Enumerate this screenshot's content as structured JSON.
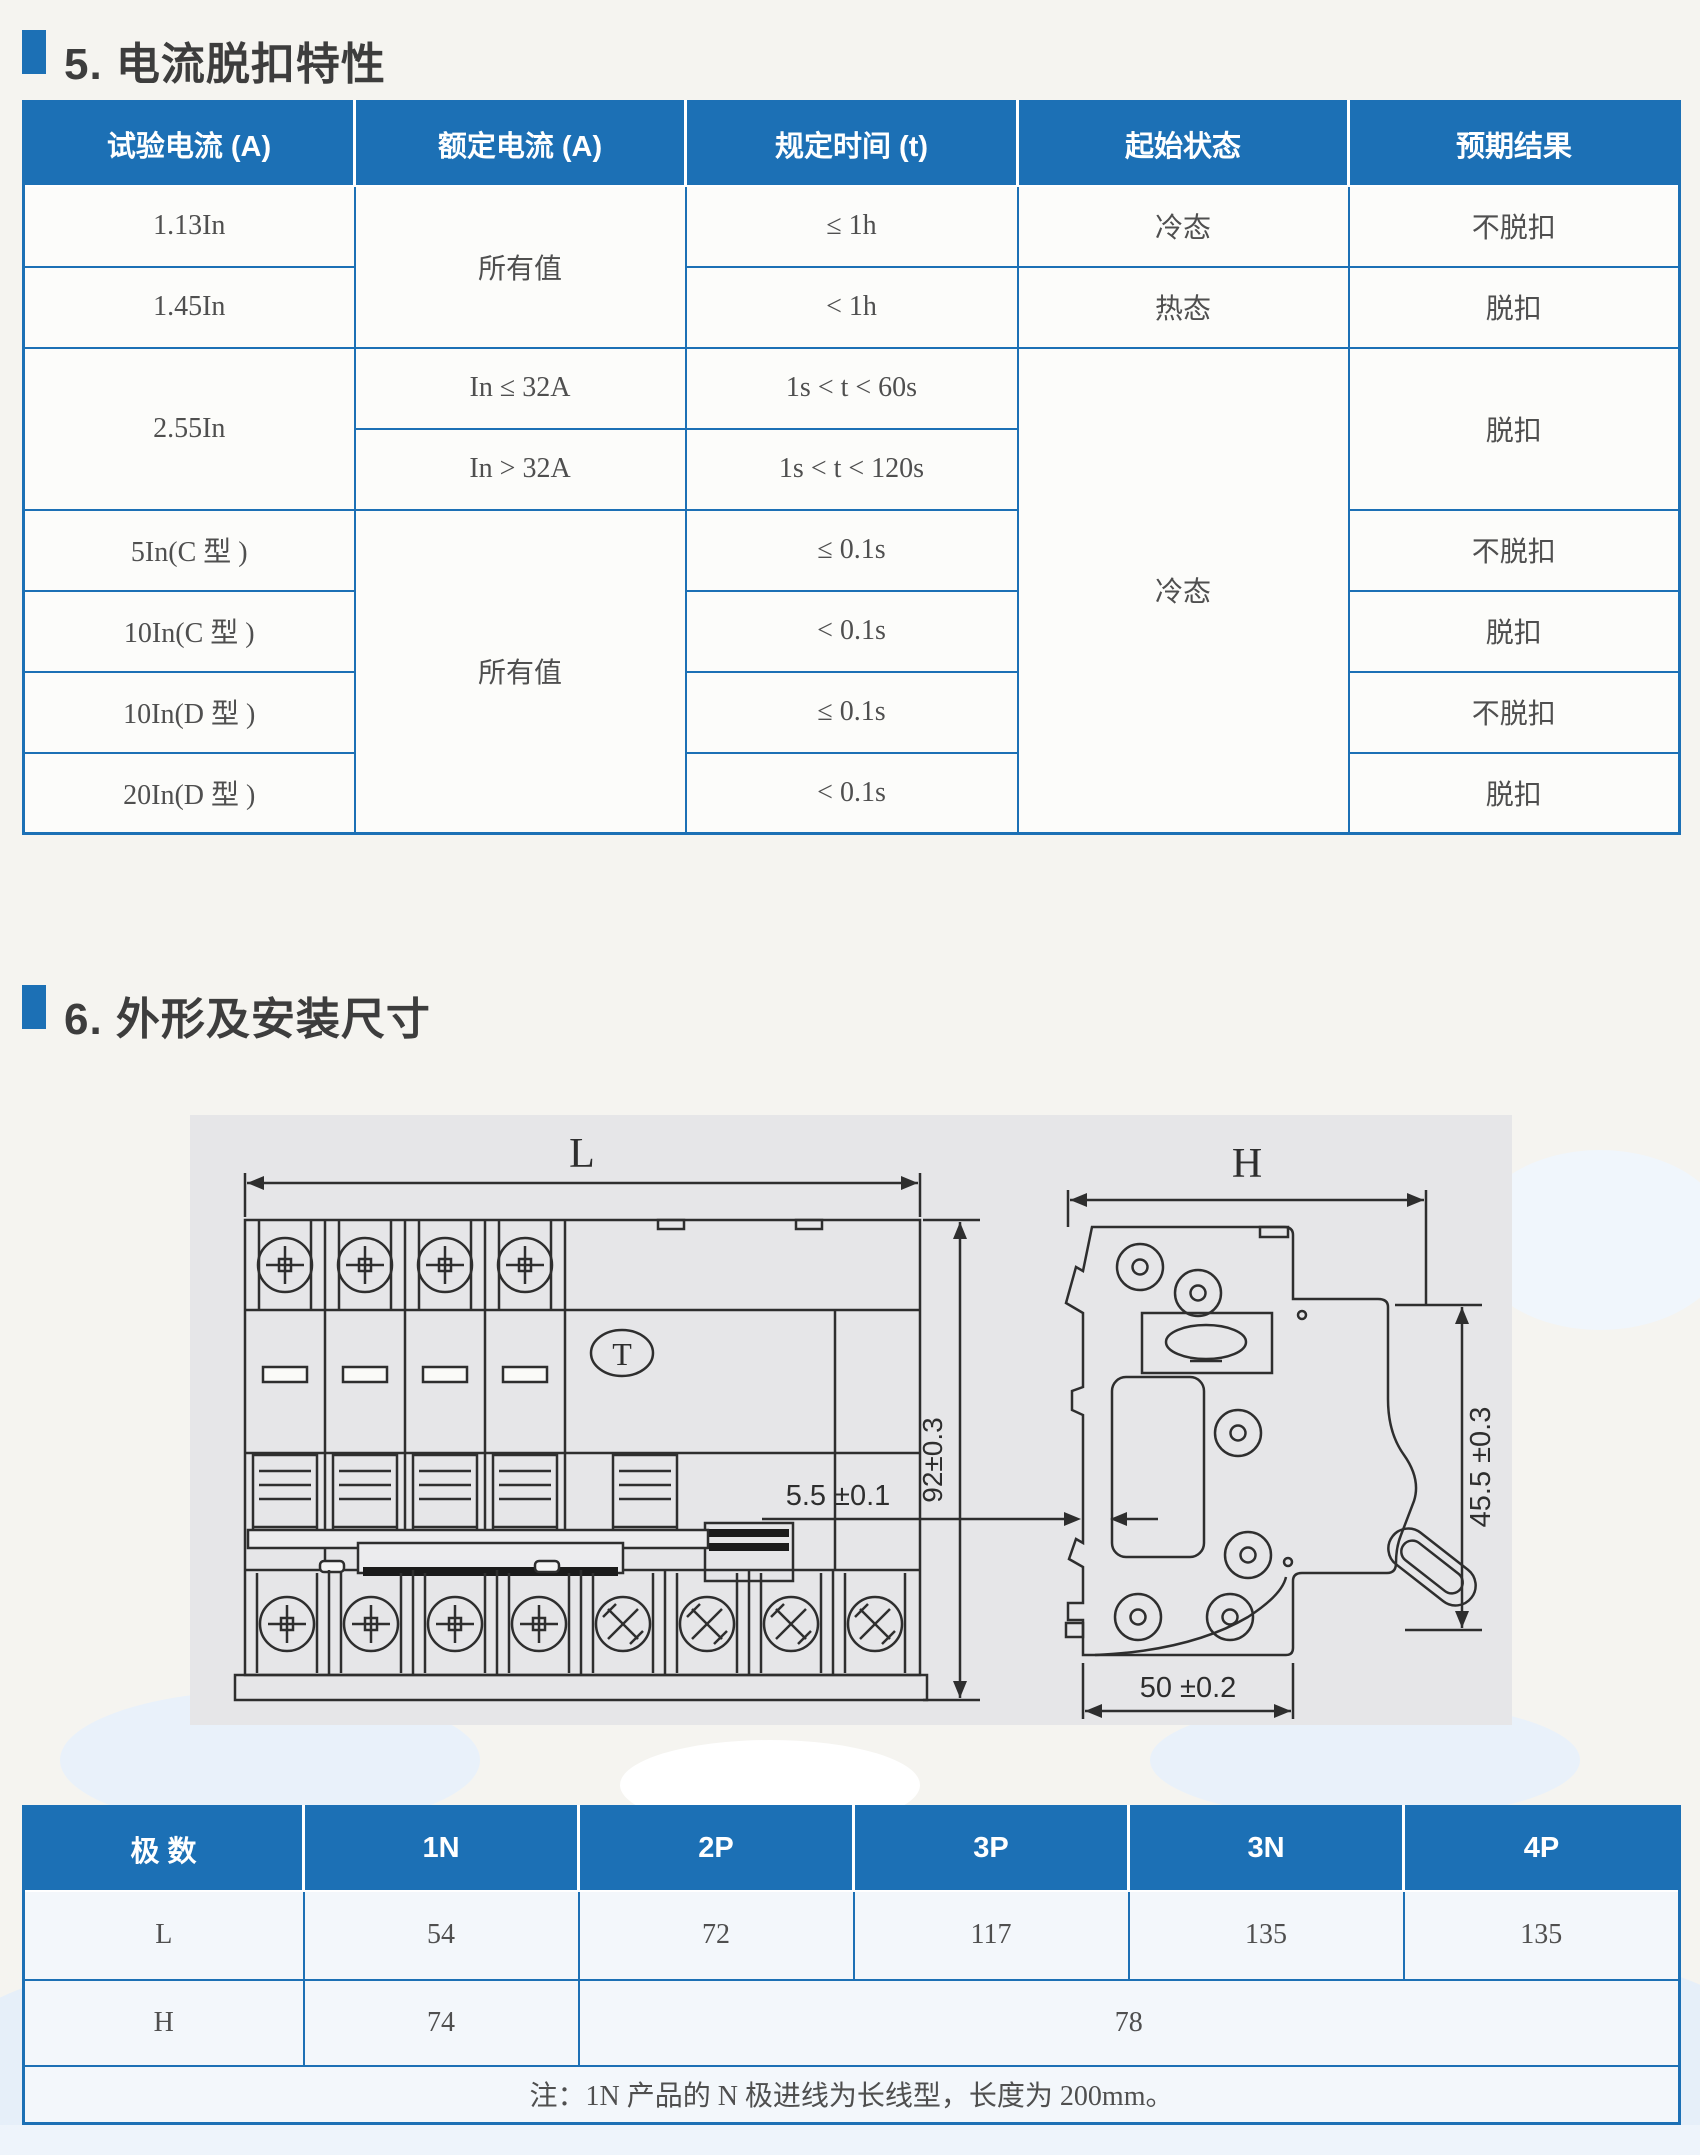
{
  "colors": {
    "accent_blue": "#1c70b5",
    "header_text": "#ffffff",
    "body_text": "#4f4f4f",
    "title_text": "#3d3d3d",
    "drawing_line": "#2e2e2e",
    "drawing_bg": "#e6e6e8"
  },
  "section5": {
    "title": "5. 电流脱扣特性"
  },
  "trip_table": {
    "headers": [
      "试验电流 (A)",
      "额定电流 (A)",
      "规定时间 (t)",
      "起始状态",
      "预期结果"
    ],
    "r1c1": "1.13In",
    "r1c2": "所有值",
    "r1c3": "≤ 1h",
    "r1c4": "冷态",
    "r1c5": "不脱扣",
    "r2c1": "1.45In",
    "r2c3": "< 1h",
    "r2c4": "热态",
    "r2c5": "脱扣",
    "r3c1": "2.55In",
    "r3c2": "In ≤ 32A",
    "r3c3": "1s < t < 60s",
    "r3c4": "冷态",
    "r3c5": "脱扣",
    "r4c2": "In > 32A",
    "r4c3": "1s < t < 120s",
    "r5c1": "5In(C 型 )",
    "r5c2": "所有值",
    "r5c3": "≤ 0.1s",
    "r5c5": "不脱扣",
    "r6c1": "10In(C 型 )",
    "r6c3": "< 0.1s",
    "r6c5": "脱扣",
    "r7c1": "10In(D 型 )",
    "r7c3": "≤ 0.1s",
    "r7c5": "不脱扣",
    "r8c1": "20In(D 型 )",
    "r8c3": "< 0.1s",
    "r8c5": "脱扣"
  },
  "section6": {
    "title": "6. 外形及安装尺寸"
  },
  "drawing": {
    "dim_L": "L",
    "dim_H": "H",
    "dim_height": "92±0.3",
    "dim_slot": "5.5 ±0.1",
    "dim_front": "45.5 ±0.3",
    "dim_depth": "50 ±0.2",
    "test_button": "T"
  },
  "size_table": {
    "headers": [
      "极 数",
      "1N",
      "2P",
      "3P",
      "3N",
      "4P"
    ],
    "rowL": {
      "label": "L",
      "v1": "54",
      "v2": "72",
      "v3": "117",
      "v4": "135",
      "v5": "135"
    },
    "rowH": {
      "label": "H",
      "v1": "74",
      "v2": "78"
    },
    "note": "注：1N 产品的 N 极进线为长线型，长度为 200mm。"
  }
}
